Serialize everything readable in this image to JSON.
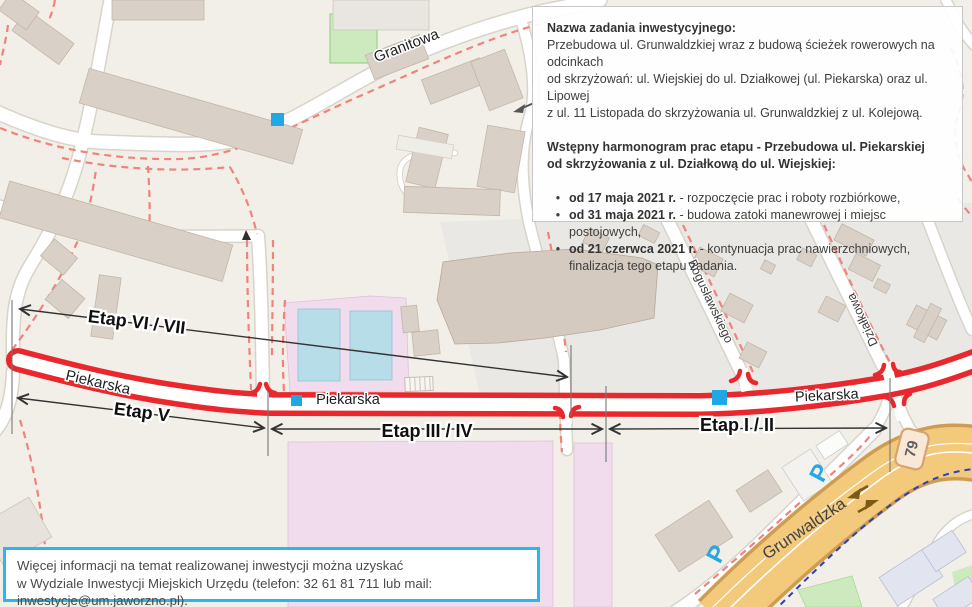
{
  "info_panel": {
    "title": "Nazwa zadania inwestycyjnego:",
    "description_lines": [
      "Przebudowa ul. Grunwaldzkiej wraz z budową ścieżek rowerowych na odcinkach",
      "od skrzyżowań: ul. Wiejskiej do ul. Działkowej (ul. Piekarska) oraz ul. Lipowej",
      "z ul. 11 Listopada do skrzyżowania ul. Grunwaldzkiej z ul. Kolejową."
    ],
    "schedule_title_lines": [
      "Wstępny harmonogram prac etapu - Przebudowa ul. Piekarskiej",
      "od skrzyżowania z ul. Działkową do ul. Wiejskiej:"
    ],
    "bullet": "•",
    "schedule_items": [
      {
        "date": "od 17 maja 2021 r.",
        "text": "- rozpoczęcie prac i roboty rozbiórkowe,"
      },
      {
        "date": "od 31 maja 2021 r.",
        "text": "- budowa zatoki manewrowej i miejsc postojowych,"
      },
      {
        "date": "od 21 czerwca 2021 r.",
        "text": "- kontynuacja prac nawierzchniowych, finalizacja tego etapu zadania."
      }
    ]
  },
  "contact_panel": {
    "lines": [
      "Więcej informacji na temat realizowanej inwestycji można uzyskać",
      "w Wydziale Inwestycji Miejskich Urzędu (telefon: 32 61 81 711 lub mail: inwestycje@um.jaworzno.pl)."
    ]
  },
  "map": {
    "street_labels": {
      "granitowa": "Granitowa",
      "piekarska": "Piekarska",
      "boguslawskiego": "Bogusławskiego",
      "dzialkowa": "Działkowa",
      "grunwaldzka": "Grunwaldzka"
    },
    "stage_labels": {
      "stage_6_7": "Etap VI / VII",
      "stage_5": "Etap V",
      "stage_3_4": "Etap III / IV",
      "stage_1_2": "Etap I / II"
    },
    "route_badge": "79",
    "parking_symbol": "P",
    "colors": {
      "stage_highlight_red": "#e8282d",
      "marker_blue": "#1fa8e4",
      "contact_border_cyan": "#2bb7e9",
      "main_road_orange": "#f3c97c",
      "cycleway_blue": "#2b3fc0"
    }
  }
}
